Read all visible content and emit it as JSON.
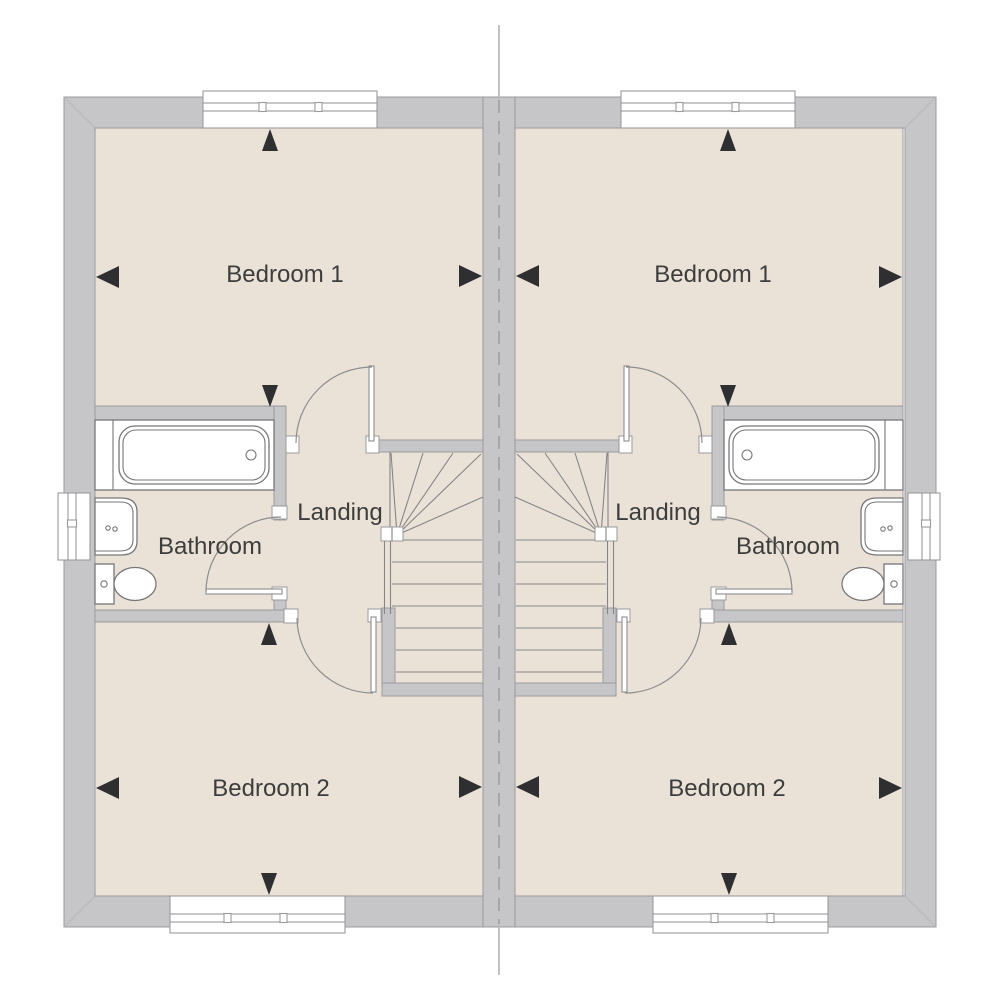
{
  "drawing": {
    "kind": "floor-plan",
    "mirrored_pair": true
  },
  "colors": {
    "wall_fill": "#c6c6c8",
    "wall_outline": "#9a9a9c",
    "floor_fill": "#eae2d6",
    "fixture_outline": "#77777a",
    "stair_line": "#85858a",
    "door_arc": "#8d8d90",
    "glazing_line": "#8f8f92",
    "party_wall_dash": "#a6a6a9",
    "centerline": "#c2c2c4",
    "miter_line": "#b6b6b8",
    "label_text": "#3d3d3d",
    "arrow_fill": "#2f2f31"
  },
  "units": [
    {
      "name": "left-dwelling",
      "rooms": {
        "bedroom1": "Bedroom 1",
        "bathroom": "Bathroom",
        "landing": "Landing",
        "bedroom2": "Bedroom 2"
      }
    },
    {
      "name": "right-dwelling",
      "rooms": {
        "bedroom1": "Bedroom 1",
        "bathroom": "Bathroom",
        "landing": "Landing",
        "bedroom2": "Bedroom 2"
      }
    }
  ]
}
